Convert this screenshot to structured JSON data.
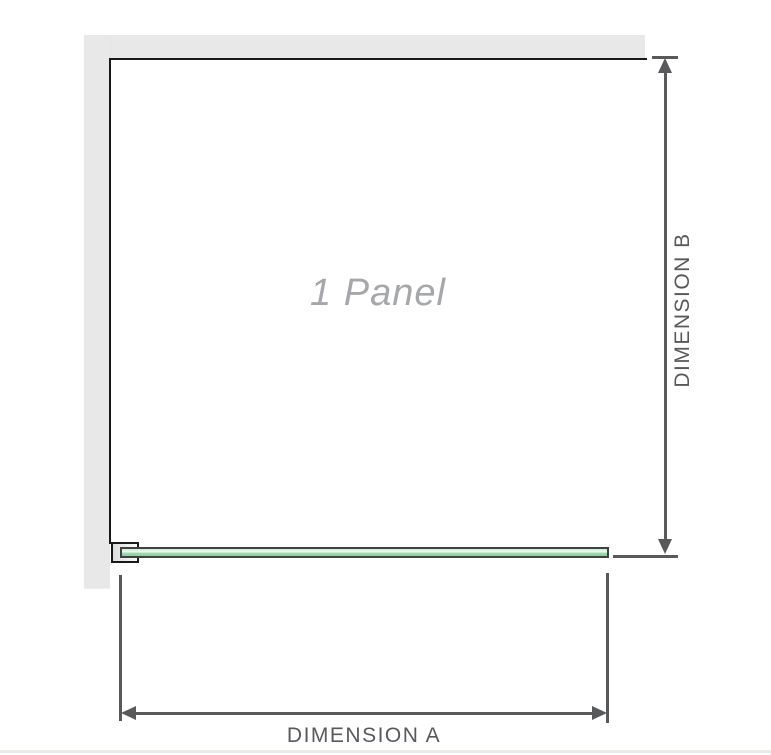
{
  "diagram": {
    "panel_label": "1 Panel",
    "dimensions": {
      "a_label": "DIMENSION A",
      "b_label": "DIMENSION B"
    },
    "icons": [
      "arrowhead-up-icon",
      "arrowhead-down-icon",
      "arrowhead-left-icon",
      "arrowhead-right-icon"
    ],
    "colors": {
      "wall": "#e8e8e8",
      "outline": "#1a1a1a",
      "dimension": "#58595b",
      "panel_label_color": "#a5a7aa",
      "glass_border": "#3f4340",
      "glass_light": "#cdebd7",
      "glass_highlight": "#eef7f0",
      "glass_fill": "#9ad4ab",
      "glass_deep": "#8fcfa2",
      "baseline_rule": "#eceae4"
    }
  }
}
